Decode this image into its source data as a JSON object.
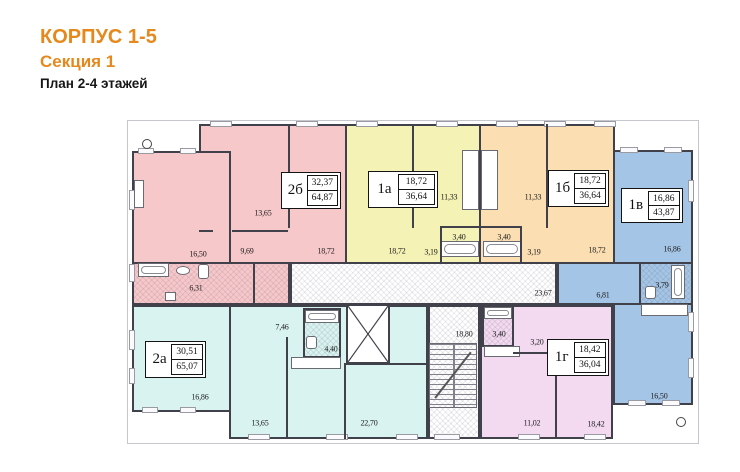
{
  "header": {
    "building": "КОРПУС 1-5",
    "section": "Секция 1",
    "plan": "План 2-4 этажей"
  },
  "apartments": [
    {
      "name": "2б",
      "living_area": "32,37",
      "total_area": "64,87",
      "color": "#F7C8CA",
      "rooms": [
        "13,65",
        "16,50",
        "9,69",
        "18,72",
        "6,31"
      ]
    },
    {
      "name": "1а",
      "living_area": "18,72",
      "total_area": "36,64",
      "color": "#F4F2B5",
      "rooms": [
        "18,72",
        "11,33",
        "3,40",
        "3,19"
      ]
    },
    {
      "name": "1б",
      "living_area": "18,72",
      "total_area": "36,64",
      "color": "#FBDFB3",
      "rooms": [
        "11,33",
        "3,40",
        "3,19",
        "18,72"
      ]
    },
    {
      "name": "1в",
      "living_area": "16,86",
      "total_area": "43,87",
      "color": "#A4C5E6",
      "rooms": [
        "16,86",
        "3,79",
        "6,81",
        "16,50"
      ]
    },
    {
      "name": "2а",
      "living_area": "30,51",
      "total_area": "65,07",
      "color": "#D8F3F0",
      "rooms": [
        "16,86",
        "7,46",
        "4,40",
        "13,65",
        "22,70"
      ]
    },
    {
      "name": "1г",
      "living_area": "18,42",
      "total_area": "36,04",
      "color": "#F3DAF0",
      "rooms": [
        "3,40",
        "3,20",
        "11,02",
        "18,42"
      ]
    }
  ],
  "common_areas": {
    "corridor_area": "23,67",
    "hall_area": "18,80"
  },
  "colors": {
    "accent": "#E5891E",
    "wall": "#41414B",
    "text": "#1C1C1C"
  }
}
